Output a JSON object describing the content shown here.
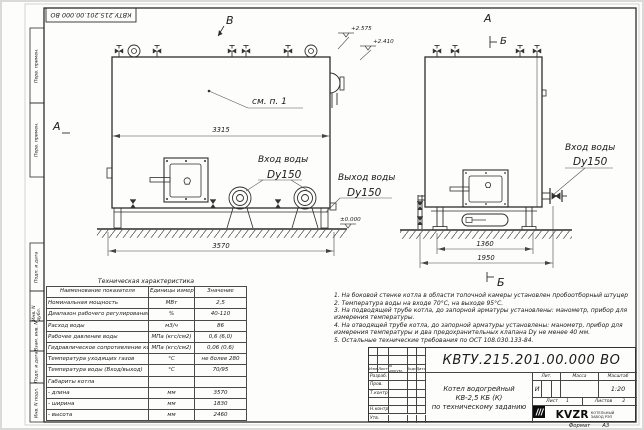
{
  "frame": {
    "stamp_top": "КВТУ.215.201.00.000 ВО",
    "margin_top_labels": [
      "Перв. примен.",
      "Перв. примен."
    ],
    "margin_bottom_labels": [
      "Подп. и дата",
      "Инв. N дубл.",
      "Взам. инв. N",
      "Подп. и дата",
      "Инв. N подл."
    ],
    "format_label": "Формат",
    "format_value": "А3"
  },
  "views": {
    "front": {
      "marker_b": "В",
      "marker_a": "А",
      "callout": "см. п. 1",
      "dim_inner": "3315",
      "dim_outer": "3570",
      "elev_top1": "+2.575",
      "elev_top2": "+2.410",
      "elev_zero": "±0.000",
      "inlet_label": "Вход воды",
      "inlet_size": "Dy150",
      "outlet_label": "Выход воды",
      "outlet_size": "Dy150"
    },
    "side": {
      "marker_a": "А",
      "marker_b_top": "Б",
      "marker_b_bottom": "Б",
      "dim_inner": "1360",
      "dim_outer": "1950",
      "inlet_label": "Вход воды",
      "inlet_size": "Dy150"
    }
  },
  "notes": [
    "1. На боковой стенке котла в области топочной камеры установлен пробоотборный штуцер",
    "2. Температура воды на входе 70°С, на выходе 95°С.",
    "3. На подводящей трубе котла, до запорной арматуры установлены: манометр, прибор для измерения температуры.",
    "4. На отводящей трубе котла, до запорной арматуры установлены: манометр, прибор для измерения температуры и два предохранительных клапана Dу не менее 40 мм.",
    "5. Остальные технические требования по ОСТ 108.030.133-84."
  ],
  "tech_table": {
    "title": "Техническая характеристика",
    "headers": [
      "Наименование показателя",
      "Единицы измерения",
      "Значение"
    ],
    "rows": [
      {
        "name": "Номинальная мощность",
        "unit": "МВт",
        "value": "2,5"
      },
      {
        "name": "Диапазон рабочего регулирования",
        "unit": "%",
        "value": "40-110"
      },
      {
        "name": "Расход воды",
        "unit": "м3/ч",
        "value": "86"
      },
      {
        "name": "Рабочее давление воды",
        "unit": "МПа (кгс/см2)",
        "value": "0,6 (6,0)"
      },
      {
        "name": "Гидравлическое сопротивление котла",
        "unit": "МПа (кгс/см2)",
        "value": "0,06 (0,6)"
      },
      {
        "name": "Температура уходящих газов",
        "unit": "°С",
        "value": "не более 280"
      },
      {
        "name": "Температура воды (Вход/выход)",
        "unit": "°С",
        "value": "70/95"
      },
      {
        "name": "Габариты котла",
        "unit": "",
        "value": ""
      },
      {
        "name": "- длина",
        "unit": "мм",
        "value": "3570"
      },
      {
        "name": "- ширина",
        "unit": "мм",
        "value": "1830"
      },
      {
        "name": "- высота",
        "unit": "мм",
        "value": "2460"
      }
    ]
  },
  "title_block": {
    "doc_number": "КВТУ.215.201.00.000 ВО",
    "name_line1": "Котел водогрейный",
    "name_line2": "КВ-2,5 КБ (К)",
    "name_line3": "по техническому заданию",
    "rev_cols": [
      "Изм",
      "Лист",
      "N докум.",
      "Подп.",
      "Дата"
    ],
    "roles": [
      "Разраб.",
      "Пров.",
      "Т.контр.",
      "",
      "Н.контр.",
      "Утв."
    ],
    "lit_label": "Лит.",
    "lit_value": "И",
    "mass_label": "Масса",
    "scale_label": "Масштаб",
    "scale_value": "1:20",
    "sheet_label": "Лист",
    "sheet_value": "1",
    "sheets_label": "Листов",
    "sheets_value": "2",
    "logo_text": "KVZR",
    "company_line1": "КОТЕЛЬНЫЙ",
    "company_line2": "ЗАВОД РЭП"
  }
}
